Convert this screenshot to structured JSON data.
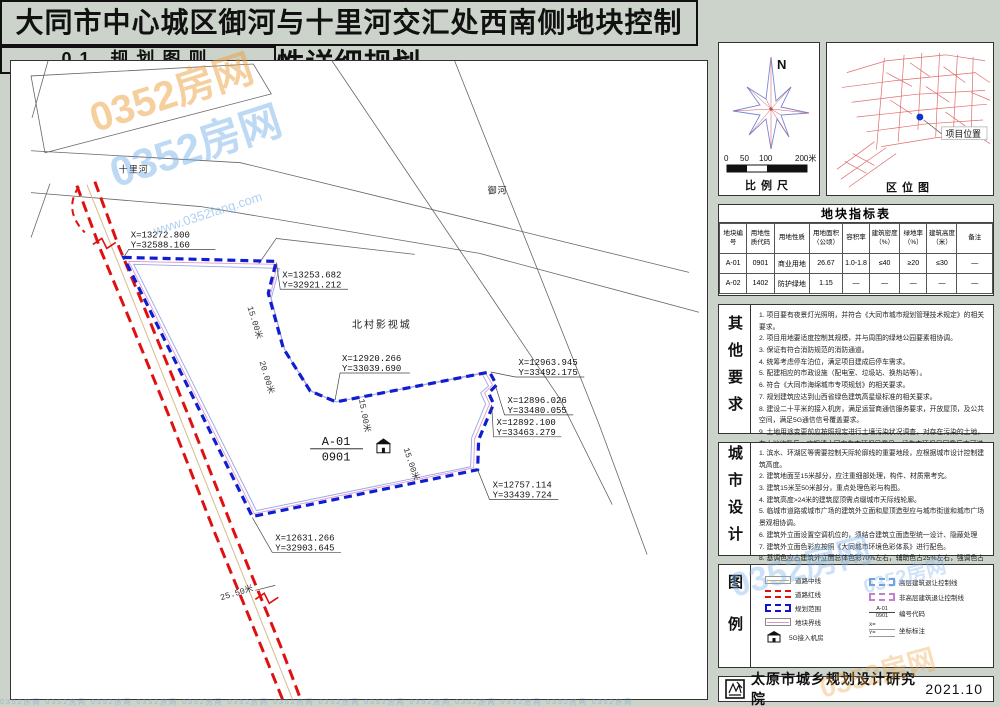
{
  "title": "大同市中心城区御河与十里河交汇处西南侧地块控制性详细规划",
  "panel": {
    "header": "01 规划图则",
    "compass": {
      "north": "N",
      "ticks": [
        "0",
        "50",
        "100",
        "200米"
      ],
      "caption": "比例尺"
    },
    "locmap": {
      "caption": "区位图",
      "marker_label": "项目位置"
    },
    "indicator_table": {
      "title": "地块指标表",
      "headers": [
        "地块编号",
        "用地性质代码",
        "用地性质",
        "用地面积（公顷）",
        "容积率",
        "建筑密度（%）",
        "绿地率（%）",
        "建筑高度（米）",
        "备注"
      ],
      "rows": [
        [
          "A-01",
          "0901",
          "商业用地",
          "26.67",
          "1.0-1.8",
          "≤40",
          "≥20",
          "≤30",
          "—"
        ],
        [
          "A-02",
          "1402",
          "防护绿地",
          "1.15",
          "—",
          "—",
          "—",
          "—",
          "—"
        ]
      ]
    },
    "other": {
      "label": "其他要求",
      "items": [
        "1. 项目要有夜景灯光照明，并符合《大同市城市规划管理技术规定》的相关要求。",
        "2. 项目用地要适度控制其规模，并与周围的绿地公园要素相协调。",
        "3. 保证有符合消防规范的消防通道。",
        "4. 统筹考虑停车泊位，满足项目建成后停车需求。",
        "5. 配建相应的市政设施（配电室、垃圾站、换热站等）。",
        "6. 符合《大同市海绵城市专项规划》的相关要求。",
        "7. 规划建筑应达到山西省绿色建筑高星级标准的相关要求。",
        "8. 建设二十平米的接入机房，满足运营商通信服务要求，开放屋顶，及公共空间，满足5G通信信号覆盖要求。",
        "9. 土地用途变更前应按照规定进行土壤污染状况调查，对存在污染的土地，在土地修复后，应报请大同市生态环保局意见，经生态环保局同意后方可进行开发建设。"
      ]
    },
    "design": {
      "label": "城市设计",
      "items": [
        "1. 滨水、环湖区等需要控制天际轮廓线的重要地段，应根据城市设计控制建筑高度。",
        "2. 建筑地面至15米部分，应注重细部处理，构件、材质需考究。",
        "3. 建筑15米至50米部分，重点处理色彩与构图。",
        "4. 建筑高度>24米的建筑屋顶需点缀城市天际线轮廓。",
        "5. 临城市道路或城市广场的建筑外立面和屋顶造型应与城市街道和城市广场景观相协调。",
        "6. 建筑外立面设置空调机位的，须结合建筑立面造型统一设计、隐蔽处理",
        "7. 建筑外立面色彩应按照《大同城市环境色彩体系》进行配色。",
        "8. 基调色应占建筑外立面总体色彩70%左右，辅助色占25%左右，强调色占5%左右。"
      ]
    },
    "legend": {
      "label": "图例",
      "left_items": [
        "道路中线",
        "道路红线",
        "规划范围",
        "地块界线",
        "5G接入机房"
      ],
      "right_items": [
        "高层建筑退让控制线",
        "非高层建筑退让控制线",
        "编号代码",
        "坐标标注"
      ],
      "code_top": "A-01",
      "code_bottom": "0901",
      "coord_x": "X=",
      "coord_y": "Y="
    },
    "footer": {
      "institution": "太原市城乡规划设计研究院",
      "date": "2021.10"
    }
  },
  "map": {
    "river_north": "十里河",
    "river_east": "御河",
    "site_label": "北村影视城",
    "plot_code_top": "A-01",
    "plot_code_bottom": "0901",
    "coordinates": [
      {
        "x": "X=13272.800",
        "y": "Y=32588.160"
      },
      {
        "x": "X=13253.682",
        "y": "Y=32921.212"
      },
      {
        "x": "X=12920.266",
        "y": "Y=33039.690"
      },
      {
        "x": "X=12963.945",
        "y": "Y=33492.175"
      },
      {
        "x": "X=12896.026",
        "y": "Y=33480.055"
      },
      {
        "x": "X=12892.100",
        "y": "Y=33463.279"
      },
      {
        "x": "X=12757.114",
        "y": "Y=33439.724"
      },
      {
        "x": "X=12631.266",
        "y": "Y=32903.645"
      }
    ],
    "dimensions": [
      "15.00米",
      "20.00米",
      "15.00米",
      "15.00米",
      "25.50米"
    ]
  },
  "watermark": {
    "brand": "0352房网",
    "site": "www.0352fang.com",
    "strip": "0352房网  0352房网  0352房网  0352房网  0352房网  0352房网  0352房网  0352房网  0352房网  0352房网  0352房网  0352房网  0352房网  0352房网"
  },
  "colors": {
    "boundary": "#0f1ed0",
    "road_red": "#e01010",
    "accent_pink": "#e39ad0",
    "accent_blue": "#96a8e8"
  }
}
